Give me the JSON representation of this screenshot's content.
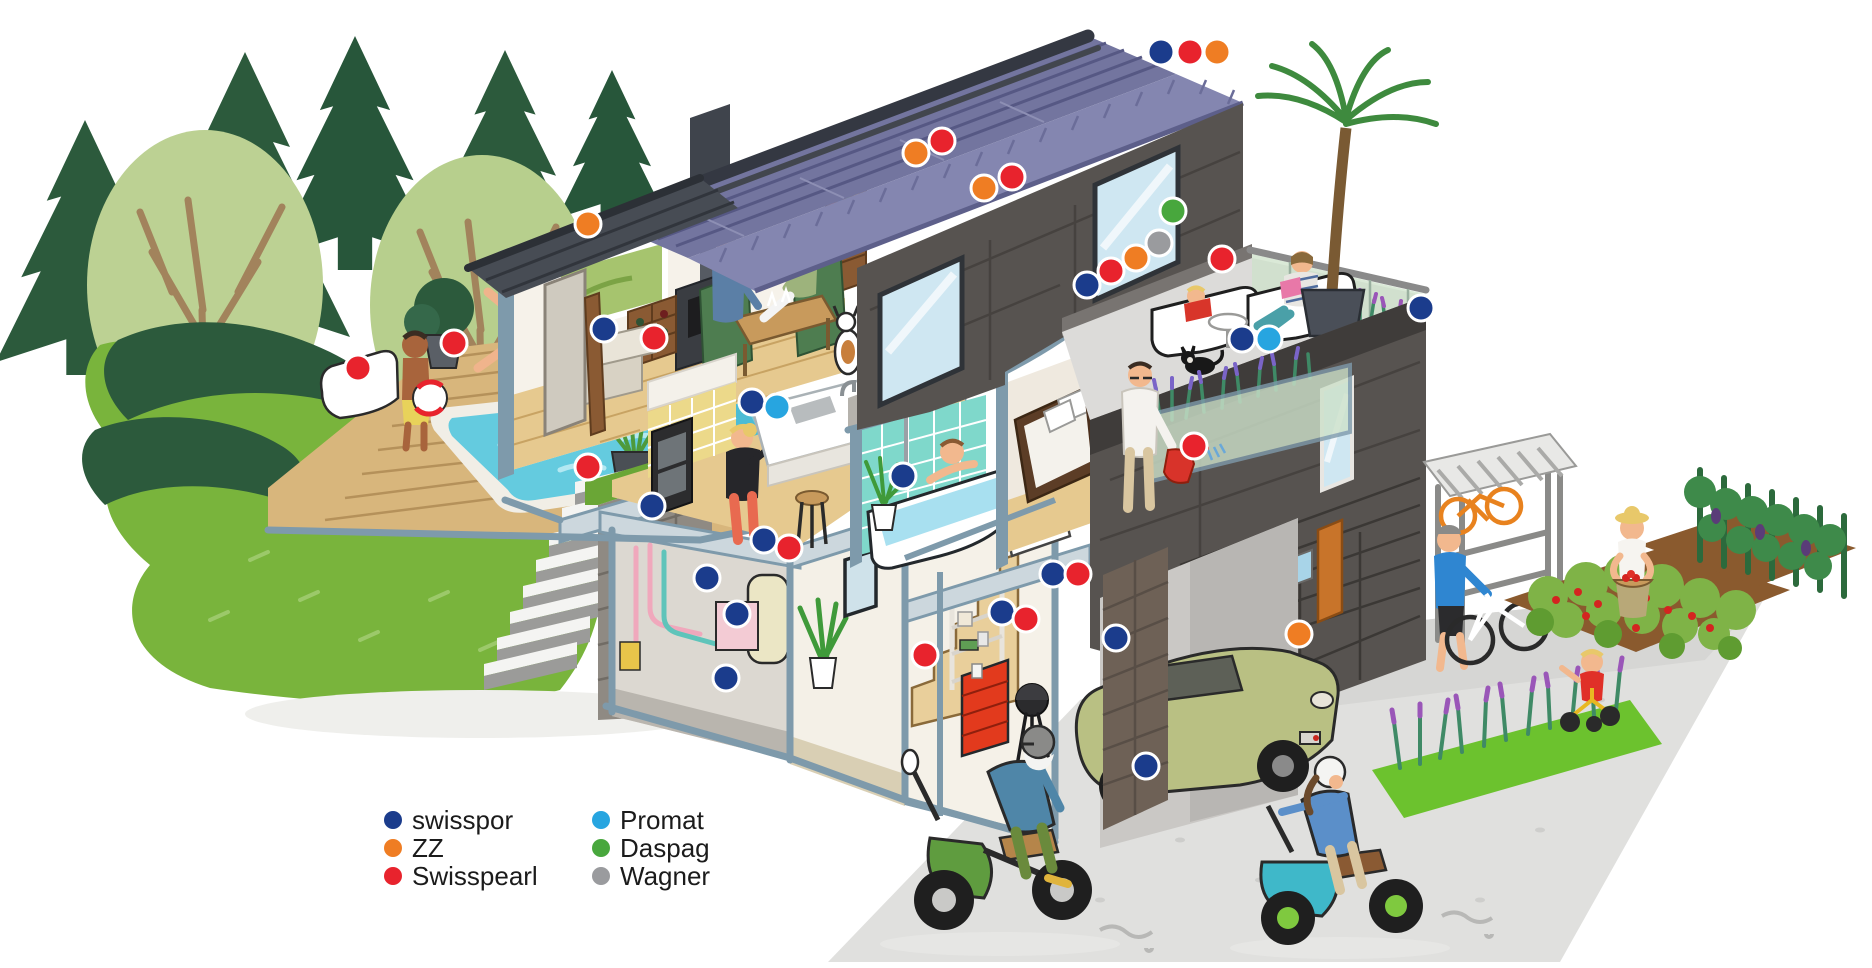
{
  "brands": {
    "swisspor": {
      "label": "swisspor",
      "color": "#1b3c8c"
    },
    "zz": {
      "label": "ZZ",
      "color": "#ef7d23"
    },
    "swisspearl": {
      "label": "Swisspearl",
      "color": "#e8232d"
    },
    "promat": {
      "label": "Promat",
      "color": "#27a5e0"
    },
    "daspag": {
      "label": "Daspag",
      "color": "#48a73d"
    },
    "wagner": {
      "label": "Wagner",
      "color": "#9a9b9e"
    }
  },
  "legend": {
    "columns": [
      {
        "items": [
          "swisspor",
          "zz",
          "swisspearl"
        ]
      },
      {
        "items": [
          "promat",
          "daspag",
          "wagner"
        ]
      }
    ]
  },
  "markers": {
    "header": [
      {
        "x": 1161,
        "y": 52,
        "brand": "swisspor"
      },
      {
        "x": 1190,
        "y": 52,
        "brand": "swisspearl"
      },
      {
        "x": 1217,
        "y": 52,
        "brand": "zz"
      }
    ],
    "scene": [
      {
        "x": 588,
        "y": 224,
        "brand": "zz",
        "location": "entrance-canopy-roof"
      },
      {
        "x": 358,
        "y": 368,
        "brand": "swisspearl",
        "location": "pool-lounger"
      },
      {
        "x": 454,
        "y": 343,
        "brand": "swisspearl",
        "location": "pool-planter"
      },
      {
        "x": 604,
        "y": 329,
        "brand": "swisspor",
        "location": "living-room-cut-wall"
      },
      {
        "x": 654,
        "y": 338,
        "brand": "swisspearl",
        "location": "wine-rack"
      },
      {
        "x": 916,
        "y": 153,
        "brand": "zz",
        "location": "solar-roof"
      },
      {
        "x": 942,
        "y": 141,
        "brand": "swisspearl",
        "location": "solar-roof"
      },
      {
        "x": 984,
        "y": 188,
        "brand": "zz",
        "location": "facade-siding"
      },
      {
        "x": 1012,
        "y": 177,
        "brand": "swisspearl",
        "location": "facade-siding"
      },
      {
        "x": 1173,
        "y": 211,
        "brand": "daspag",
        "location": "upper-facade"
      },
      {
        "x": 1159,
        "y": 243,
        "brand": "wagner",
        "location": "roof-terrace"
      },
      {
        "x": 1136,
        "y": 258,
        "brand": "zz",
        "location": "roof-terrace"
      },
      {
        "x": 1111,
        "y": 271,
        "brand": "swisspearl",
        "location": "roof-terrace"
      },
      {
        "x": 1087,
        "y": 285,
        "brand": "swisspor",
        "location": "roof-terrace"
      },
      {
        "x": 1222,
        "y": 259,
        "brand": "swisspearl",
        "location": "terrace-lounger"
      },
      {
        "x": 1242,
        "y": 339,
        "brand": "swisspor",
        "location": "terrace-floor"
      },
      {
        "x": 1269,
        "y": 339,
        "brand": "promat",
        "location": "terrace-floor"
      },
      {
        "x": 1421,
        "y": 308,
        "brand": "swisspor",
        "location": "glass-railing"
      },
      {
        "x": 752,
        "y": 402,
        "brand": "swisspor",
        "location": "kitchen-island"
      },
      {
        "x": 777,
        "y": 407,
        "brand": "promat",
        "location": "kitchen-island"
      },
      {
        "x": 903,
        "y": 476,
        "brand": "swisspor",
        "location": "bathroom-tiles"
      },
      {
        "x": 1194,
        "y": 446,
        "brand": "swisspearl",
        "location": "balcony-planter"
      },
      {
        "x": 588,
        "y": 467,
        "brand": "swisspearl",
        "location": "pool-deck-planter"
      },
      {
        "x": 652,
        "y": 506,
        "brand": "swisspor",
        "location": "basement-ceiling-edge"
      },
      {
        "x": 764,
        "y": 540,
        "brand": "swisspor",
        "location": "boiler-room-ceiling"
      },
      {
        "x": 789,
        "y": 548,
        "brand": "swisspearl",
        "location": "boiler-room-ceiling"
      },
      {
        "x": 707,
        "y": 578,
        "brand": "swisspor",
        "location": "boiler-room-wall"
      },
      {
        "x": 737,
        "y": 614,
        "brand": "swisspor",
        "location": "boiler"
      },
      {
        "x": 726,
        "y": 678,
        "brand": "swisspor",
        "location": "basement-floor"
      },
      {
        "x": 925,
        "y": 655,
        "brand": "swisspearl",
        "location": "basement-stairs"
      },
      {
        "x": 1053,
        "y": 574,
        "brand": "swisspor",
        "location": "hobby-room-ceiling"
      },
      {
        "x": 1078,
        "y": 574,
        "brand": "swisspearl",
        "location": "hobby-room-ceiling"
      },
      {
        "x": 1002,
        "y": 612,
        "brand": "swisspor",
        "location": "garage-shelf"
      },
      {
        "x": 1026,
        "y": 619,
        "brand": "swisspearl",
        "location": "garage-shelf"
      },
      {
        "x": 1116,
        "y": 638,
        "brand": "swisspor",
        "location": "garage-column"
      },
      {
        "x": 1299,
        "y": 634,
        "brand": "zz",
        "location": "garage-brick-wall"
      },
      {
        "x": 1146,
        "y": 766,
        "brand": "swisspor",
        "location": "garage-column-base"
      }
    ]
  }
}
